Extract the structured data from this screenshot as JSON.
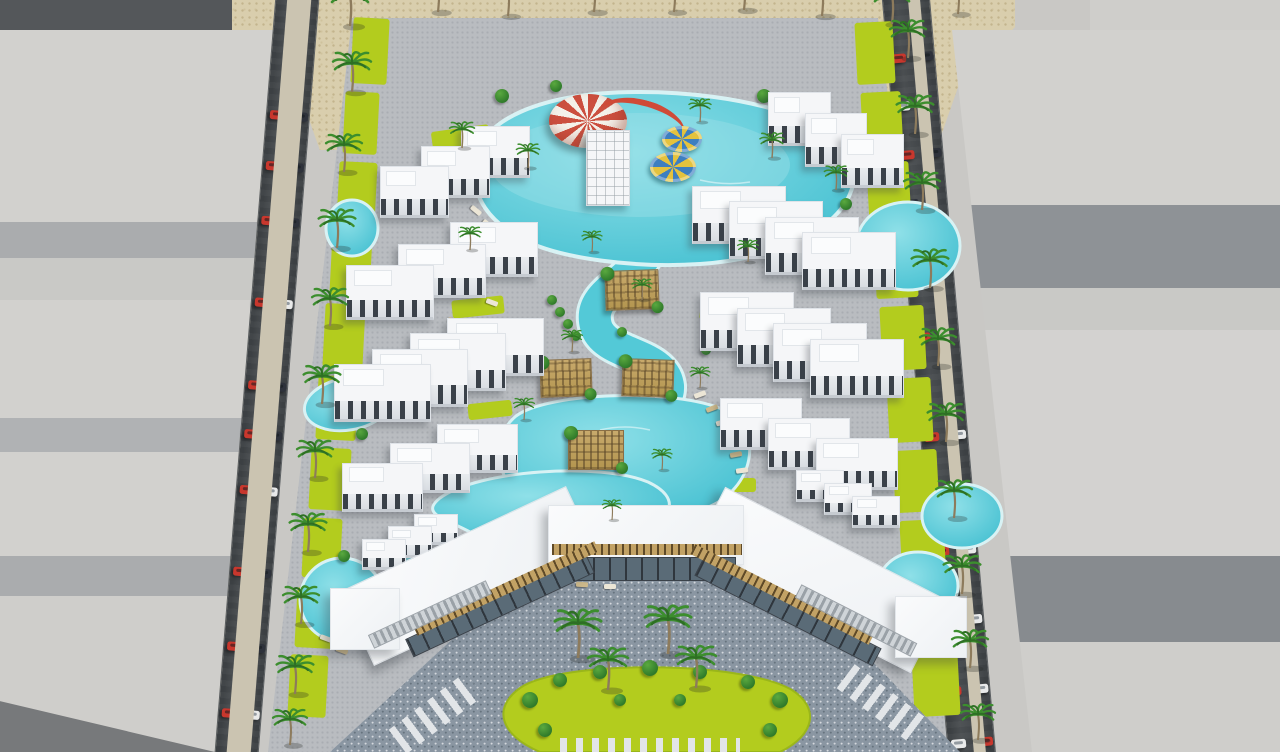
{
  "scene": {
    "description": "Aerial 3D architectural rendering of a seaside resort compound: white low-rise apartment clusters arranged around a winding turquoise lazy-river pool with a kids aqua-play canopy, slide tower and ring floats; a large angled clubhouse with stone plaza and palm courtyard at the front; palm-lined perimeter streets with passing cars; untextured grey context block models on both sides and desert sand behind."
  },
  "palette": {
    "ground": "#c9c8c5",
    "sand": "#d9cead",
    "sandDot": "#c3b48d",
    "mShadow": "#54575a",
    "mLight": "#d2d1ce",
    "mMid": "#aaacae",
    "mMid2": "#b0b2b4",
    "mDark": "#8e9296",
    "mDark2": "#878b8f",
    "road": "#43474a",
    "walk": "#cbc4b1",
    "pave": "#b9bcc0",
    "paveDot": "#a9adb2",
    "cobble": "#8a96a2",
    "lawn": "#b3cc1e",
    "water": "#53c9d7",
    "waterLight": "#9fe2e9",
    "waterEdge": "#d8f2f4",
    "bldg": "#f5f6f8",
    "win": "#3a4149",
    "carRed": "#c8372d",
    "carDark": "#2e323b",
    "carWhite": "#e9eaea",
    "canopyRed": "#cc4f3f",
    "slide": "#d04a37",
    "floatY": "#e4c23e",
    "floatB": "#3e7fc0",
    "pergola": "#c2a265",
    "bush": "#2f7a2a",
    "palm": "#3c8e2e",
    "palmDark": "#2e6f24",
    "trunk": "#8d7b5c"
  },
  "sand_strip": {
    "x": 225,
    "y": 0,
    "w": 790,
    "h": 150,
    "clip": "polygon(0 0,100% 0,100% 18%,93% 55%,90% 100%,12% 100%,9% 55%,0 28%)"
  },
  "roads": {
    "left": {
      "cx": 285,
      "angle": 4.6,
      "outerWalk": 12,
      "asphalt": 44,
      "innerWalk": 24,
      "car_pairs": [
        [
          112,
          [
            "red",
            "dark"
          ]
        ],
        [
          163,
          [
            "red",
            "dark"
          ]
        ],
        [
          218,
          [
            "red",
            "dark"
          ]
        ],
        [
          300,
          [
            "red",
            "white"
          ]
        ],
        [
          383,
          [
            "red",
            "dark"
          ]
        ],
        [
          432,
          [
            "red",
            "dark"
          ]
        ],
        [
          488,
          [
            "red",
            "white"
          ]
        ],
        [
          570,
          [
            "red",
            "dark"
          ]
        ],
        [
          645,
          [
            "red",
            "dark"
          ]
        ],
        [
          712,
          [
            "red",
            "white"
          ]
        ]
      ]
    },
    "right": {
      "cx": 958,
      "angle": -5,
      "outerWalk": 12,
      "asphalt": 48,
      "innerWalk": 26,
      "car_pairs": [
        [
          50,
          [
            "red",
            "dark"
          ]
        ],
        [
          98,
          [
            "white"
          ]
        ],
        [
          147,
          [
            "red",
            "dark"
          ]
        ],
        [
          196,
          [
            "dark"
          ]
        ],
        [
          255,
          [
            "red",
            "dark"
          ]
        ],
        [
          330,
          [
            "red"
          ]
        ],
        [
          430,
          [
            "red",
            "white"
          ]
        ],
        [
          485,
          [
            "red",
            "dark"
          ]
        ],
        [
          545,
          [
            "red",
            "white"
          ]
        ],
        [
          615,
          [
            "red",
            "white"
          ]
        ],
        [
          685,
          [
            "red",
            "white"
          ]
        ],
        [
          738,
          [
            "white",
            "red"
          ]
        ]
      ]
    }
  },
  "palms": {
    "sand": [
      [
        350,
        26,
        1.0
      ],
      [
        438,
        12,
        0.92
      ],
      [
        508,
        16,
        0.88
      ],
      [
        594,
        12,
        0.92
      ],
      [
        674,
        12,
        0.88
      ],
      [
        744,
        10,
        0.92
      ],
      [
        822,
        16,
        0.92
      ],
      [
        892,
        24,
        0.95
      ],
      [
        958,
        14,
        0.85
      ]
    ],
    "left_road": [
      [
        352,
        92,
        0.95
      ],
      [
        344,
        172,
        0.9
      ],
      [
        337,
        248,
        0.92
      ],
      [
        330,
        326,
        0.9
      ],
      [
        322,
        404,
        0.92
      ],
      [
        315,
        478,
        0.9
      ],
      [
        308,
        552,
        0.92
      ],
      [
        301,
        624,
        0.9
      ],
      [
        295,
        694,
        0.92
      ],
      [
        290,
        745,
        0.85
      ]
    ],
    "right_road": [
      [
        908,
        58,
        0.9
      ],
      [
        915,
        134,
        0.92
      ],
      [
        922,
        210,
        0.9
      ],
      [
        930,
        288,
        0.92
      ],
      [
        938,
        366,
        0.9
      ],
      [
        946,
        442,
        0.92
      ],
      [
        954,
        518,
        0.9
      ],
      [
        962,
        594,
        0.92
      ],
      [
        970,
        668,
        0.9
      ],
      [
        978,
        740,
        0.85
      ]
    ],
    "inner": [
      [
        462,
        148,
        0.62
      ],
      [
        528,
        168,
        0.58
      ],
      [
        700,
        122,
        0.55
      ],
      [
        772,
        158,
        0.6
      ],
      [
        836,
        190,
        0.58
      ],
      [
        592,
        252,
        0.5
      ],
      [
        642,
        300,
        0.5
      ],
      [
        572,
        352,
        0.52
      ],
      [
        700,
        388,
        0.5
      ],
      [
        524,
        420,
        0.52
      ],
      [
        662,
        470,
        0.5
      ],
      [
        612,
        520,
        0.48
      ],
      [
        470,
        250,
        0.55
      ],
      [
        748,
        262,
        0.52
      ]
    ],
    "lawn": [
      [
        578,
        658,
        1.15
      ],
      [
        608,
        690,
        1.0
      ],
      [
        668,
        654,
        1.15
      ],
      [
        696,
        688,
        1.0
      ]
    ]
  },
  "resort": {
    "top_building": {
      "center_bar": [
        470,
        20,
        330,
        72
      ],
      "left_wing": [
        455,
        105,
        170,
        62,
        -33
      ],
      "right_wing": [
        838,
        108,
        170,
        62,
        33
      ]
    },
    "clusters": [
      {
        "x": 380,
        "y": 126,
        "w": 150,
        "h": 92,
        "dir": "L"
      },
      {
        "x": 346,
        "y": 222,
        "w": 192,
        "h": 98,
        "dir": "L"
      },
      {
        "x": 334,
        "y": 318,
        "w": 210,
        "h": 104,
        "dir": "L"
      },
      {
        "x": 342,
        "y": 424,
        "w": 176,
        "h": 88,
        "dir": "L"
      },
      {
        "x": 362,
        "y": 514,
        "w": 96,
        "h": 56,
        "dir": "L"
      },
      {
        "x": 768,
        "y": 92,
        "w": 136,
        "h": 96,
        "dir": "R"
      },
      {
        "x": 692,
        "y": 186,
        "w": 204,
        "h": 104,
        "dir": "R"
      },
      {
        "x": 700,
        "y": 292,
        "w": 204,
        "h": 106,
        "dir": "R"
      },
      {
        "x": 720,
        "y": 398,
        "w": 178,
        "h": 92,
        "dir": "R"
      },
      {
        "x": 796,
        "y": 470,
        "w": 104,
        "h": 58,
        "dir": "R"
      }
    ],
    "lawn_patches": [
      [
        352,
        18,
        36,
        66,
        3
      ],
      [
        344,
        92,
        34,
        62,
        3
      ],
      [
        338,
        162,
        38,
        62,
        3
      ],
      [
        331,
        232,
        40,
        64,
        3
      ],
      [
        324,
        304,
        40,
        64,
        3
      ],
      [
        317,
        376,
        40,
        64,
        3
      ],
      [
        310,
        448,
        40,
        62,
        3
      ],
      [
        303,
        518,
        38,
        60,
        3
      ],
      [
        296,
        588,
        38,
        60,
        3
      ],
      [
        289,
        655,
        38,
        62,
        3
      ],
      [
        856,
        22,
        38,
        62,
        -3
      ],
      [
        862,
        92,
        40,
        62,
        -3
      ],
      [
        868,
        162,
        42,
        64,
        -3
      ],
      [
        875,
        234,
        42,
        64,
        -3
      ],
      [
        881,
        306,
        44,
        64,
        -3
      ],
      [
        888,
        378,
        44,
        64,
        -3
      ],
      [
        894,
        450,
        44,
        62,
        -3
      ],
      [
        901,
        520,
        44,
        62,
        -3
      ],
      [
        907,
        588,
        44,
        60,
        -3
      ],
      [
        913,
        652,
        46,
        64,
        -3
      ],
      [
        432,
        128,
        58,
        22,
        -8
      ],
      [
        540,
        116,
        44,
        16,
        0
      ],
      [
        756,
        120,
        52,
        20,
        8
      ],
      [
        498,
        208,
        48,
        18,
        -6
      ],
      [
        752,
        212,
        52,
        18,
        6
      ],
      [
        452,
        298,
        52,
        18,
        -6
      ],
      [
        700,
        304,
        48,
        18,
        6
      ],
      [
        468,
        402,
        44,
        16,
        -6
      ],
      [
        726,
        428,
        44,
        16,
        6
      ],
      [
        508,
        470,
        40,
        14,
        0
      ],
      [
        716,
        478,
        40,
        14,
        0
      ]
    ],
    "water": {
      "top_pool": "M474,170 C474,118 545,92 640,92 C735,92 852,118 854,172 C856,220 790,258 700,264 C640,268 560,260 520,238 C488,220 474,198 474,170 Z",
      "river": "M644,258 C620,288 588,296 596,326 C604,356 664,352 668,386 C670,414 618,418 590,440 C566,458 566,482 592,498 C612,510 634,514 636,532",
      "mid_lagoon": "M516,416 C548,392 676,388 724,410 C766,430 754,490 706,508 C650,526 556,524 524,500 C494,476 490,438 516,416 Z",
      "lower_lagoon": "M440,498 C478,470 600,462 648,482 C682,498 674,520 634,532 C586,546 500,546 470,532 C444,518 420,514 440,498 Z",
      "ponds": [
        [
          352,
          228,
          26,
          28,
          0
        ],
        [
          348,
          404,
          44,
          26,
          -10
        ],
        [
          342,
          600,
          42,
          42,
          0
        ],
        [
          908,
          246,
          52,
          44,
          0
        ],
        [
          918,
          586,
          40,
          34,
          0
        ],
        [
          962,
          516,
          40,
          32,
          0
        ],
        [
          414,
          566,
          26,
          20,
          0
        ],
        [
          812,
          562,
          32,
          24,
          0
        ]
      ],
      "sparkles": [
        "M560,140 q30,-8 60,0",
        "M700,180 q25,6 50,2",
        "M600,430 q25,-6 50,0",
        "M540,540 q20,5 40,2"
      ]
    },
    "features": {
      "canopy": [
        549,
        94,
        78,
        54
      ],
      "slide_tower": [
        586,
        130,
        44,
        76
      ],
      "slide_flume": [
        598,
        100,
        88,
        46,
        16
      ],
      "floats": [
        [
          662,
          126,
          40,
          26
        ],
        [
          650,
          152,
          46,
          30
        ]
      ]
    },
    "pergolas": [
      [
        632,
        290,
        54,
        40,
        -2
      ],
      [
        566,
        378,
        52,
        38,
        -2
      ],
      [
        648,
        378,
        52,
        38,
        2
      ],
      [
        596,
        450,
        56,
        40,
        0
      ]
    ],
    "loungers": [
      [
        470,
        208,
        40
      ],
      [
        482,
        222,
        40
      ],
      [
        494,
        236,
        40
      ],
      [
        506,
        250,
        40
      ],
      [
        452,
        252,
        25
      ],
      [
        462,
        268,
        25
      ],
      [
        474,
        284,
        25
      ],
      [
        486,
        300,
        20
      ],
      [
        448,
        318,
        10
      ],
      [
        456,
        334,
        10
      ],
      [
        694,
        392,
        -20
      ],
      [
        706,
        406,
        -20
      ],
      [
        716,
        420,
        -15
      ],
      [
        724,
        436,
        -10
      ],
      [
        730,
        452,
        -10
      ],
      [
        736,
        468,
        -8
      ],
      [
        806,
        216,
        -35
      ],
      [
        818,
        228,
        -40
      ],
      [
        830,
        242,
        -45
      ],
      [
        560,
        512,
        8
      ],
      [
        584,
        520,
        5
      ],
      [
        608,
        526,
        3
      ],
      [
        656,
        524,
        -5
      ],
      [
        682,
        516,
        -8
      ],
      [
        520,
        566,
        10
      ],
      [
        548,
        576,
        6
      ],
      [
        576,
        582,
        3
      ],
      [
        604,
        584,
        0
      ],
      [
        320,
        636,
        20
      ],
      [
        336,
        648,
        20
      ]
    ],
    "bushes": [
      [
        502,
        96,
        7
      ],
      [
        556,
        86,
        6
      ],
      [
        764,
        96,
        7
      ],
      [
        824,
        124,
        6
      ],
      [
        846,
        204,
        6
      ],
      [
        622,
        332,
        5
      ],
      [
        552,
        300,
        5
      ],
      [
        560,
        312,
        5
      ],
      [
        568,
        324,
        5
      ],
      [
        576,
        336,
        5
      ],
      [
        362,
        434,
        6
      ],
      [
        344,
        556,
        6
      ],
      [
        742,
        342,
        5
      ],
      [
        706,
        350,
        5
      ]
    ]
  },
  "clubhouse": {
    "center_bar": [
      548,
      505,
      196,
      60
    ],
    "left_wing": [
      470,
      576,
      250,
      82,
      -25
    ],
    "right_wing": [
      818,
      580,
      250,
      82,
      27
    ],
    "end_boxes": [
      [
        330,
        588,
        70,
        62
      ],
      [
        895,
        596,
        72,
        62
      ]
    ],
    "facades": [
      [
        648,
        569,
        176,
        24,
        0,
        "glass"
      ],
      [
        647,
        549,
        190,
        11,
        0,
        "slat"
      ],
      [
        500,
        606,
        200,
        20,
        -25,
        "glass"
      ],
      [
        506,
        588,
        200,
        11,
        -25,
        "slat"
      ],
      [
        788,
        612,
        200,
        20,
        27,
        "glass"
      ],
      [
        782,
        594,
        200,
        11,
        27,
        "slat"
      ],
      [
        430,
        614,
        130,
        15,
        -25,
        "stairs"
      ],
      [
        856,
        620,
        130,
        15,
        27,
        "stairs"
      ]
    ],
    "plaza": "M560,540 L755,540 L960,752 L330,752 Z",
    "stripe_bars": [
      [
        388,
        698,
        96,
        30,
        -37
      ],
      [
        836,
        690,
        96,
        30,
        37
      ],
      [
        560,
        738,
        180,
        22,
        0
      ]
    ],
    "lawn": "M520,688 C560,660 740,660 792,690 C820,708 815,735 780,752 L540,752 C500,735 492,708 520,688 Z",
    "courtyard_bushes": [
      [
        530,
        700,
        8
      ],
      [
        560,
        680,
        7
      ],
      [
        600,
        672,
        7
      ],
      [
        650,
        668,
        8
      ],
      [
        700,
        672,
        7
      ],
      [
        748,
        682,
        7
      ],
      [
        780,
        700,
        8
      ],
      [
        545,
        730,
        7
      ],
      [
        770,
        730,
        7
      ],
      [
        620,
        700,
        6
      ],
      [
        680,
        700,
        6
      ]
    ]
  }
}
